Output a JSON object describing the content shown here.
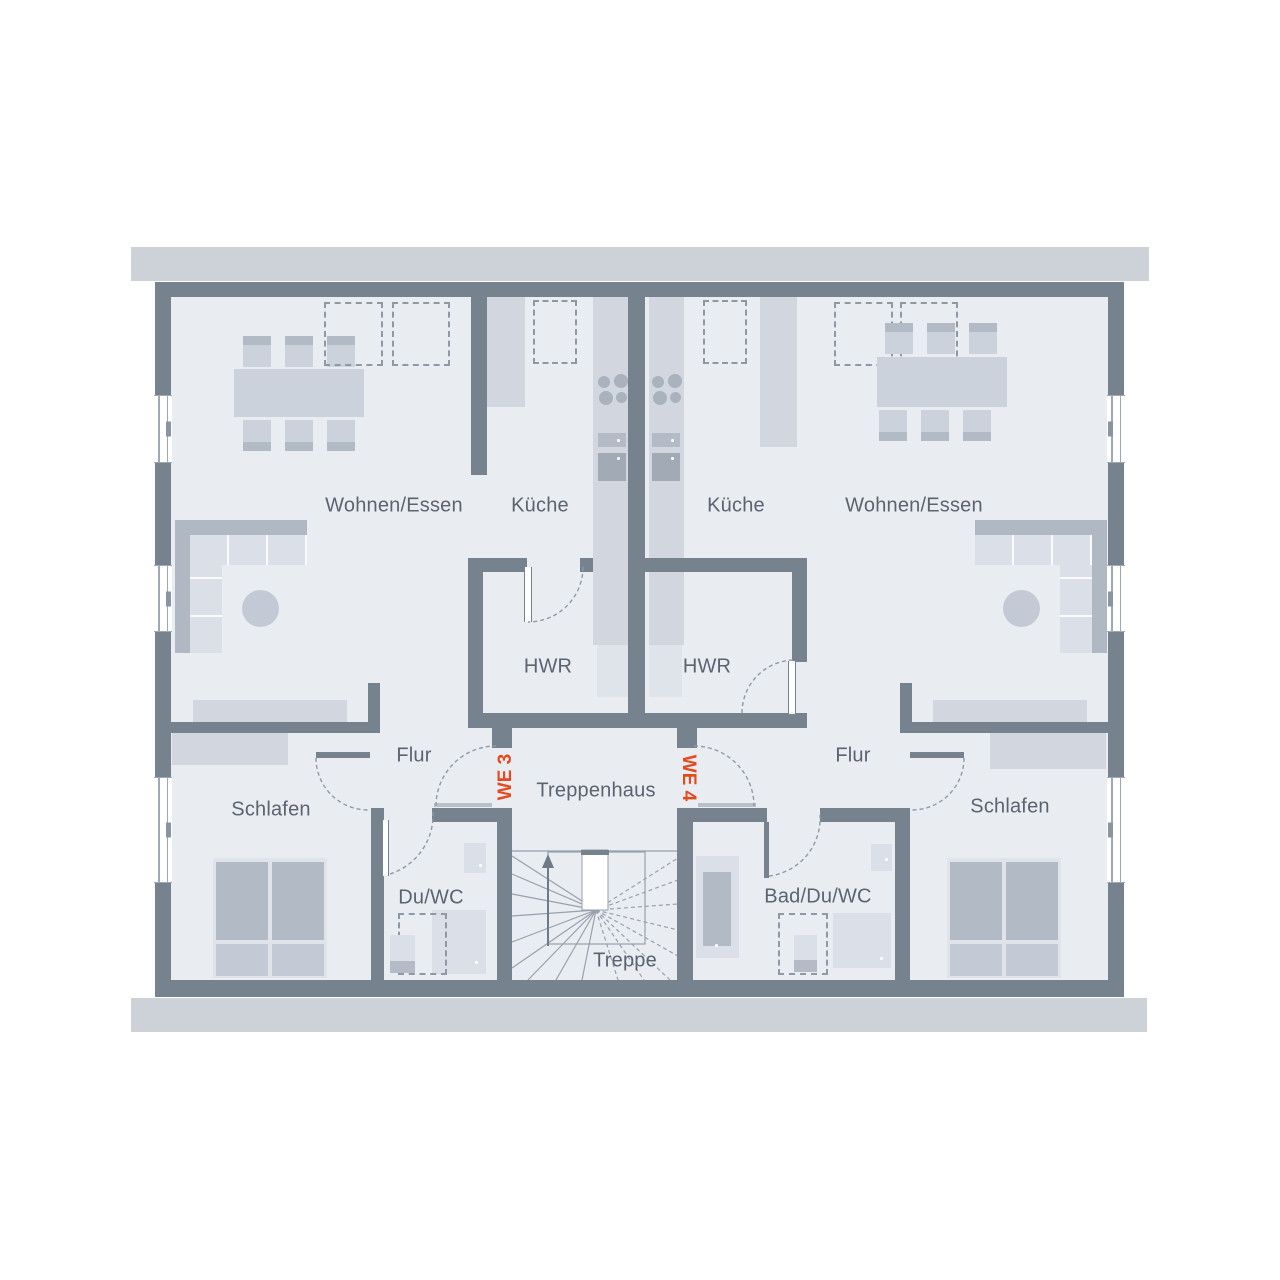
{
  "plan": {
    "units": {
      "left": "WE 3",
      "right": "WE 4"
    },
    "rooms": {
      "living_left": "Wohnen/Essen",
      "kitchen_left": "Küche",
      "kitchen_right": "Küche",
      "living_right": "Wohnen/Essen",
      "hwr_left": "HWR",
      "hwr_right": "HWR",
      "hall_left": "Flur",
      "hall_right": "Flur",
      "bedroom_left": "Schlafen",
      "bedroom_right": "Schlafen",
      "bath_left": "Du/WC",
      "bath_right": "Bad/Du/WC",
      "stairwell": "Treppenhaus",
      "stairs": "Treppe"
    },
    "colors": {
      "wall": "#76828e",
      "room_fill": "#e9edf2",
      "eaves": "#cdd2d9",
      "label_text": "#5b6371",
      "unit_label": "#e6491d"
    }
  }
}
